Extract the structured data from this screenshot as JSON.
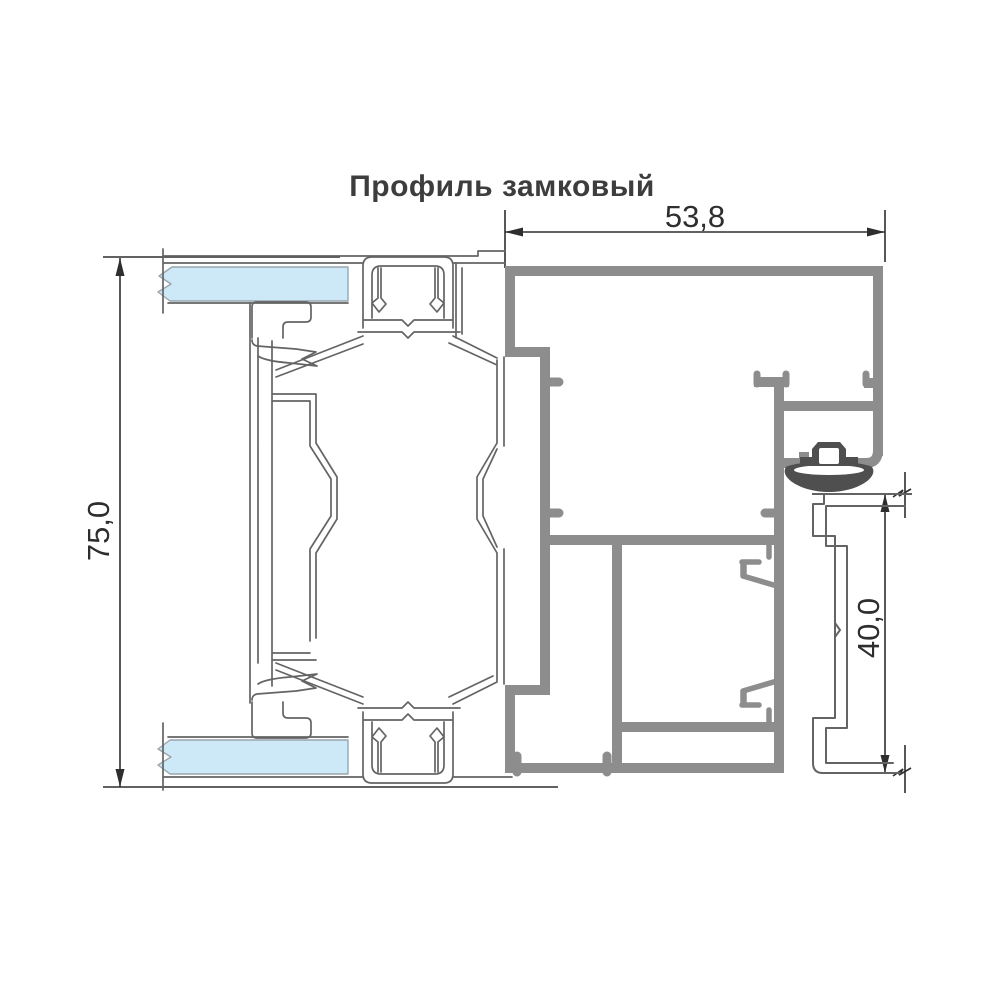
{
  "title": "Профиль замковый",
  "dimensions": {
    "overall_width": "53,8",
    "overall_height": "75,0",
    "lock_section_height": "40,0"
  },
  "colors": {
    "background": "#ffffff",
    "line": "#646464",
    "thick_profile": "#8d8d8d",
    "gasket": "#4f4f4f",
    "glass": "#cde8f7",
    "glass_line": "#98a6ae",
    "dim": "#2e2e2e",
    "title_text": "#3d3d3d"
  }
}
